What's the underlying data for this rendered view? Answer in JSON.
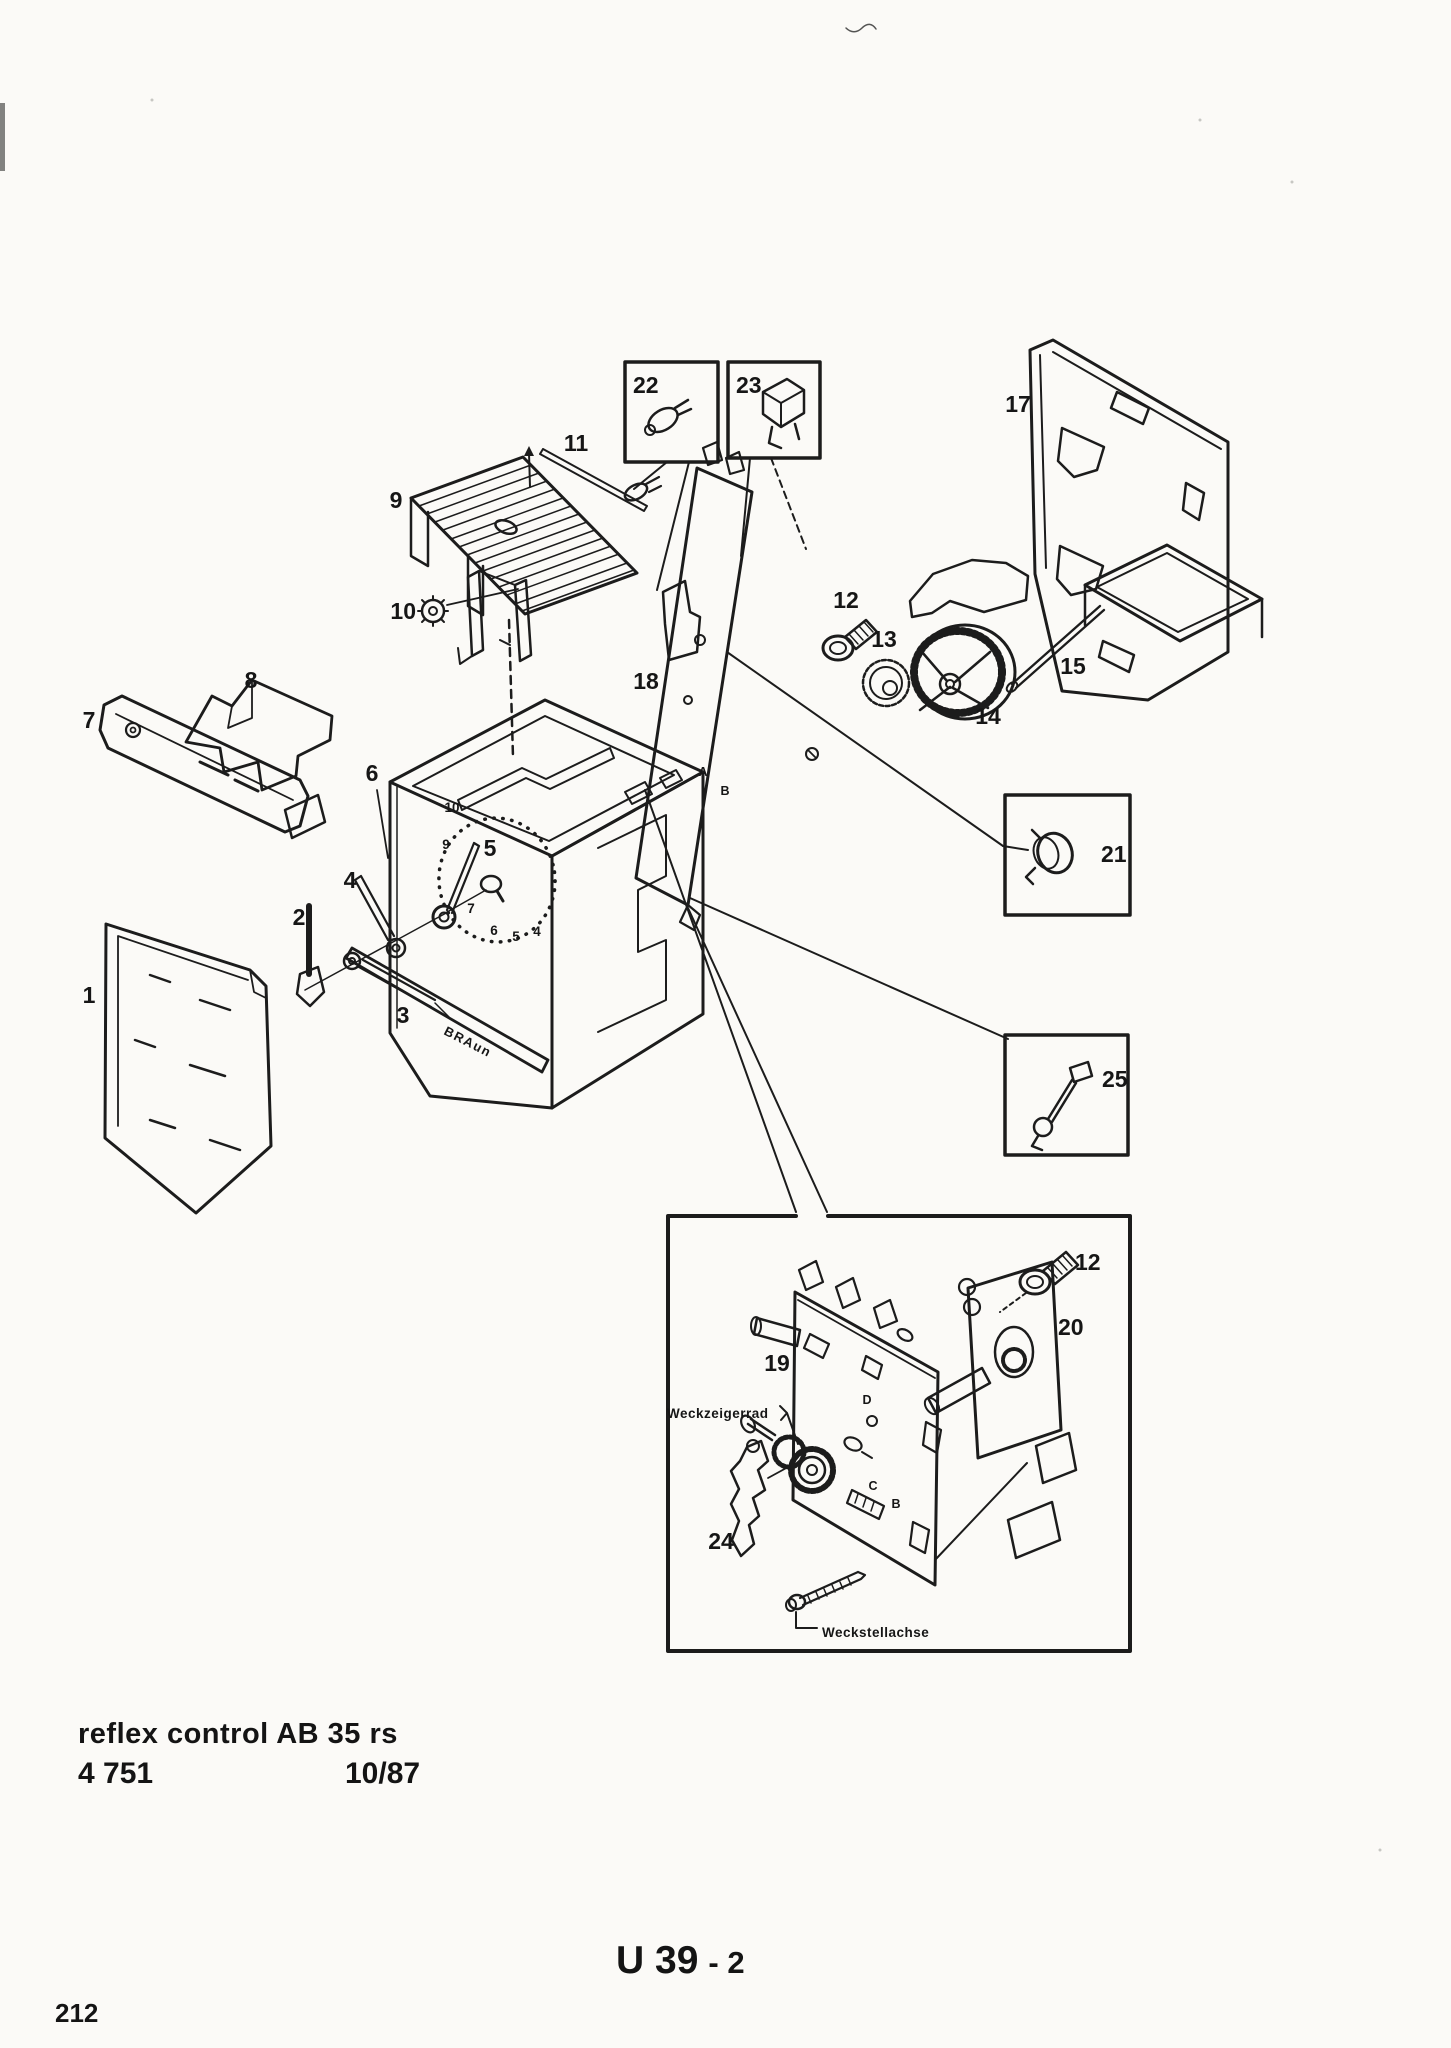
{
  "document": {
    "product_line": "reflex control AB 35 rs",
    "type_number": "4 751",
    "date_code": "10/87",
    "sheet_code": "U 39",
    "sheet_suffix": "- 2",
    "page_number": "212"
  },
  "diagram": {
    "brand_logo": "BRAun",
    "part_labels": [
      "22",
      "23",
      "17",
      "9",
      "11",
      "10",
      "8",
      "7",
      "6",
      "18",
      "12",
      "13",
      "14",
      "15",
      "21",
      "25",
      "4",
      "2",
      "5",
      "3",
      "1",
      "12",
      "20",
      "19",
      "24"
    ],
    "dial_numbers": [
      "10",
      "9",
      "7",
      "6",
      "5",
      "4"
    ],
    "callout_letters": {
      "plate_a": "A",
      "plate_b": "B",
      "gear_d": "D",
      "gear_c": "C",
      "gear_b": "B"
    },
    "annotations": {
      "weckzeigerrad": "Weckzeigerrad",
      "weckstellachse": "Weckstellachse"
    }
  }
}
